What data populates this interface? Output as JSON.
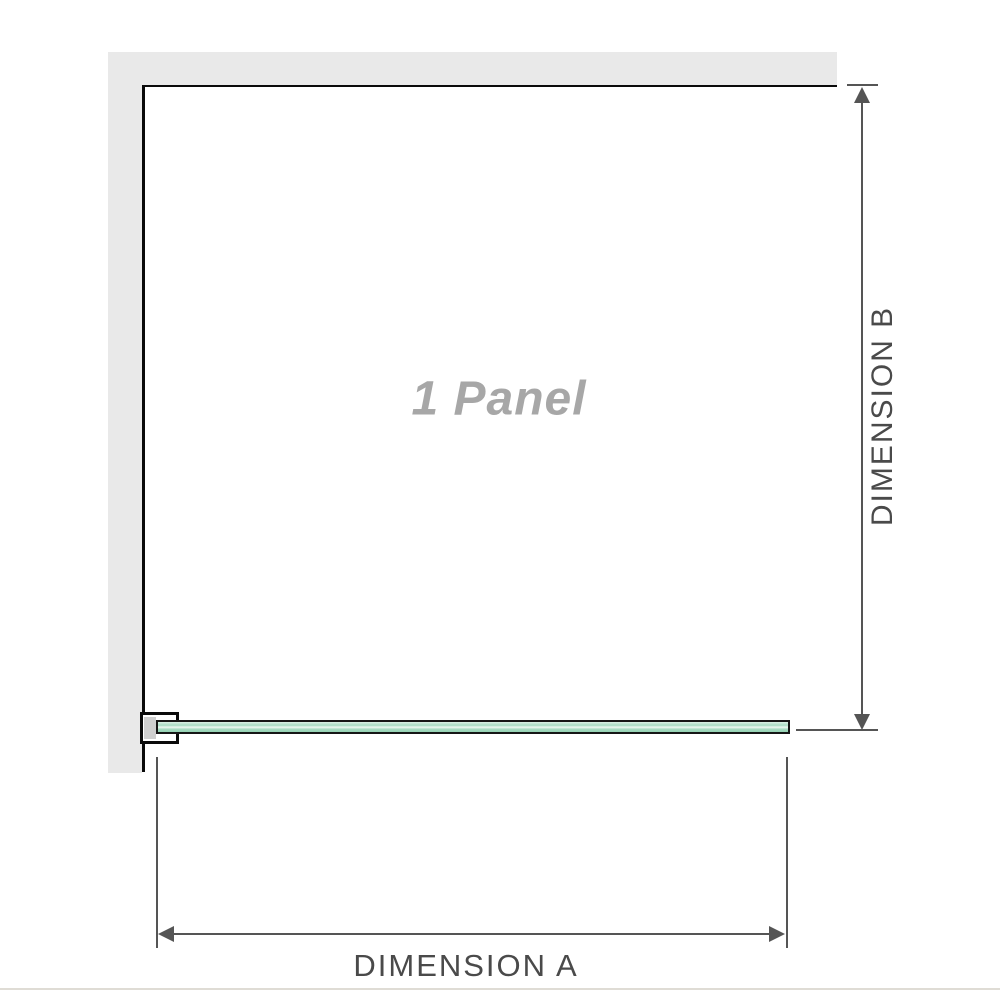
{
  "diagram": {
    "panel_label": "1 Panel",
    "dimension_a_label": "DIMENSION A",
    "dimension_b_label": "DIMENSION B"
  },
  "icons": {
    "arrow_up": "dimension-arrowhead-up",
    "arrow_down": "dimension-arrowhead-down",
    "arrow_left": "dimension-arrowhead-left",
    "arrow_right": "dimension-arrowhead-right"
  },
  "colors": {
    "wall": "#e9e9e9",
    "outline": "#0a0a0a",
    "dim": "#555555",
    "dim_text": "#4a4a4a",
    "panel_text": "#a7a7a7",
    "glass_border": "#161616",
    "glass_a": "#dcf1e6",
    "glass_b": "#a8dcc3",
    "glass_c": "#eef9f2",
    "glass_d": "#93d1b2",
    "clamp_fill": "#ffffff",
    "clamp_pad": "#cfcfcf",
    "divider": "#dfdcd5",
    "bg": "#ffffff"
  }
}
